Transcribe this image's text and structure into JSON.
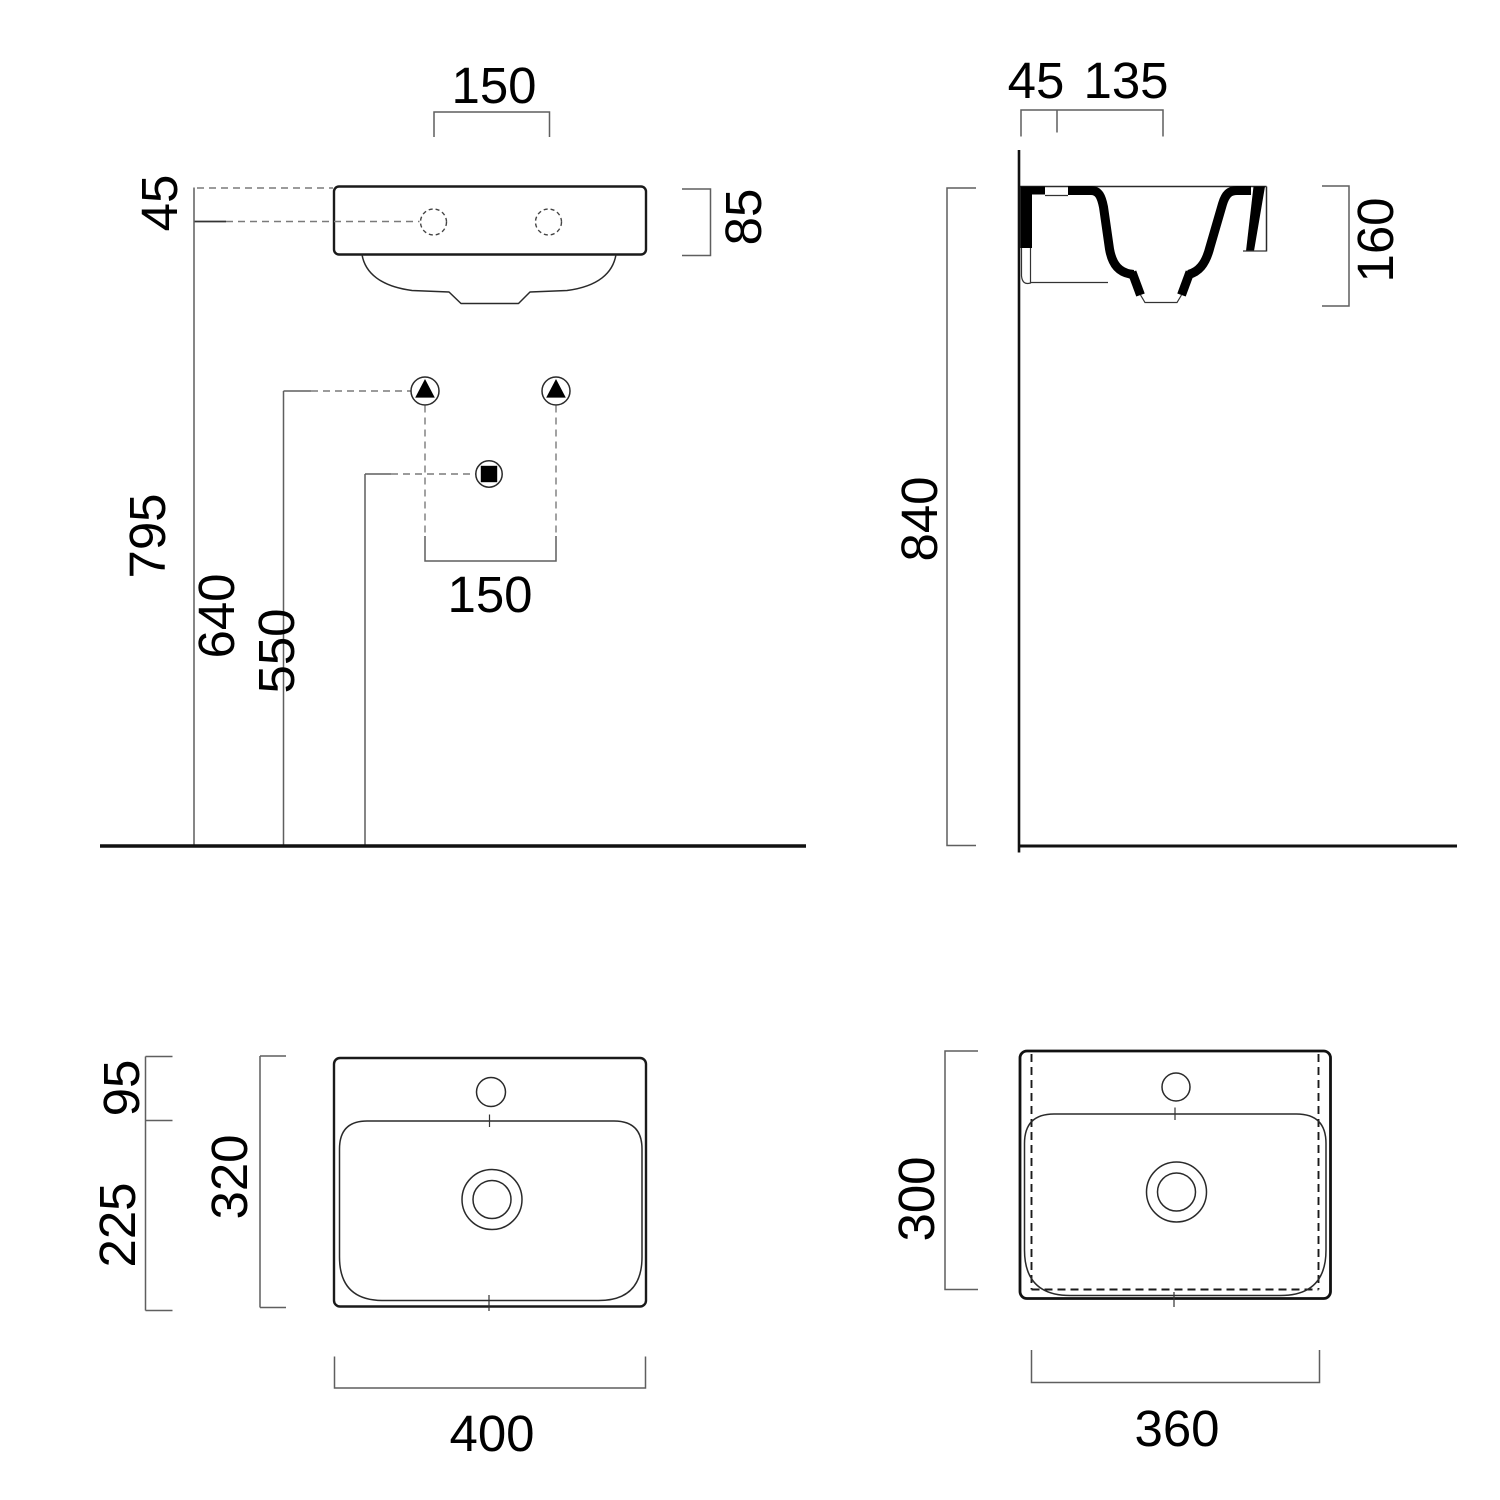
{
  "drawing": {
    "title": "wall-hung washbasin dimensional drawing",
    "front": {
      "tap_spacing_top": "150",
      "rim_to_tap": "45",
      "rim_height": "85",
      "height_rim": "795",
      "height_supply": "640",
      "height_waste": "550",
      "supply_spacing": "150"
    },
    "side": {
      "wall_offset": "45",
      "tap_to_front": "135",
      "basin_depth": "160",
      "mount_height": "840"
    },
    "plan": {
      "deck_depth": "95",
      "bowl_depth": "225",
      "total_depth": "320",
      "width": "400"
    },
    "plan_b": {
      "depth": "300",
      "width": "360"
    }
  }
}
